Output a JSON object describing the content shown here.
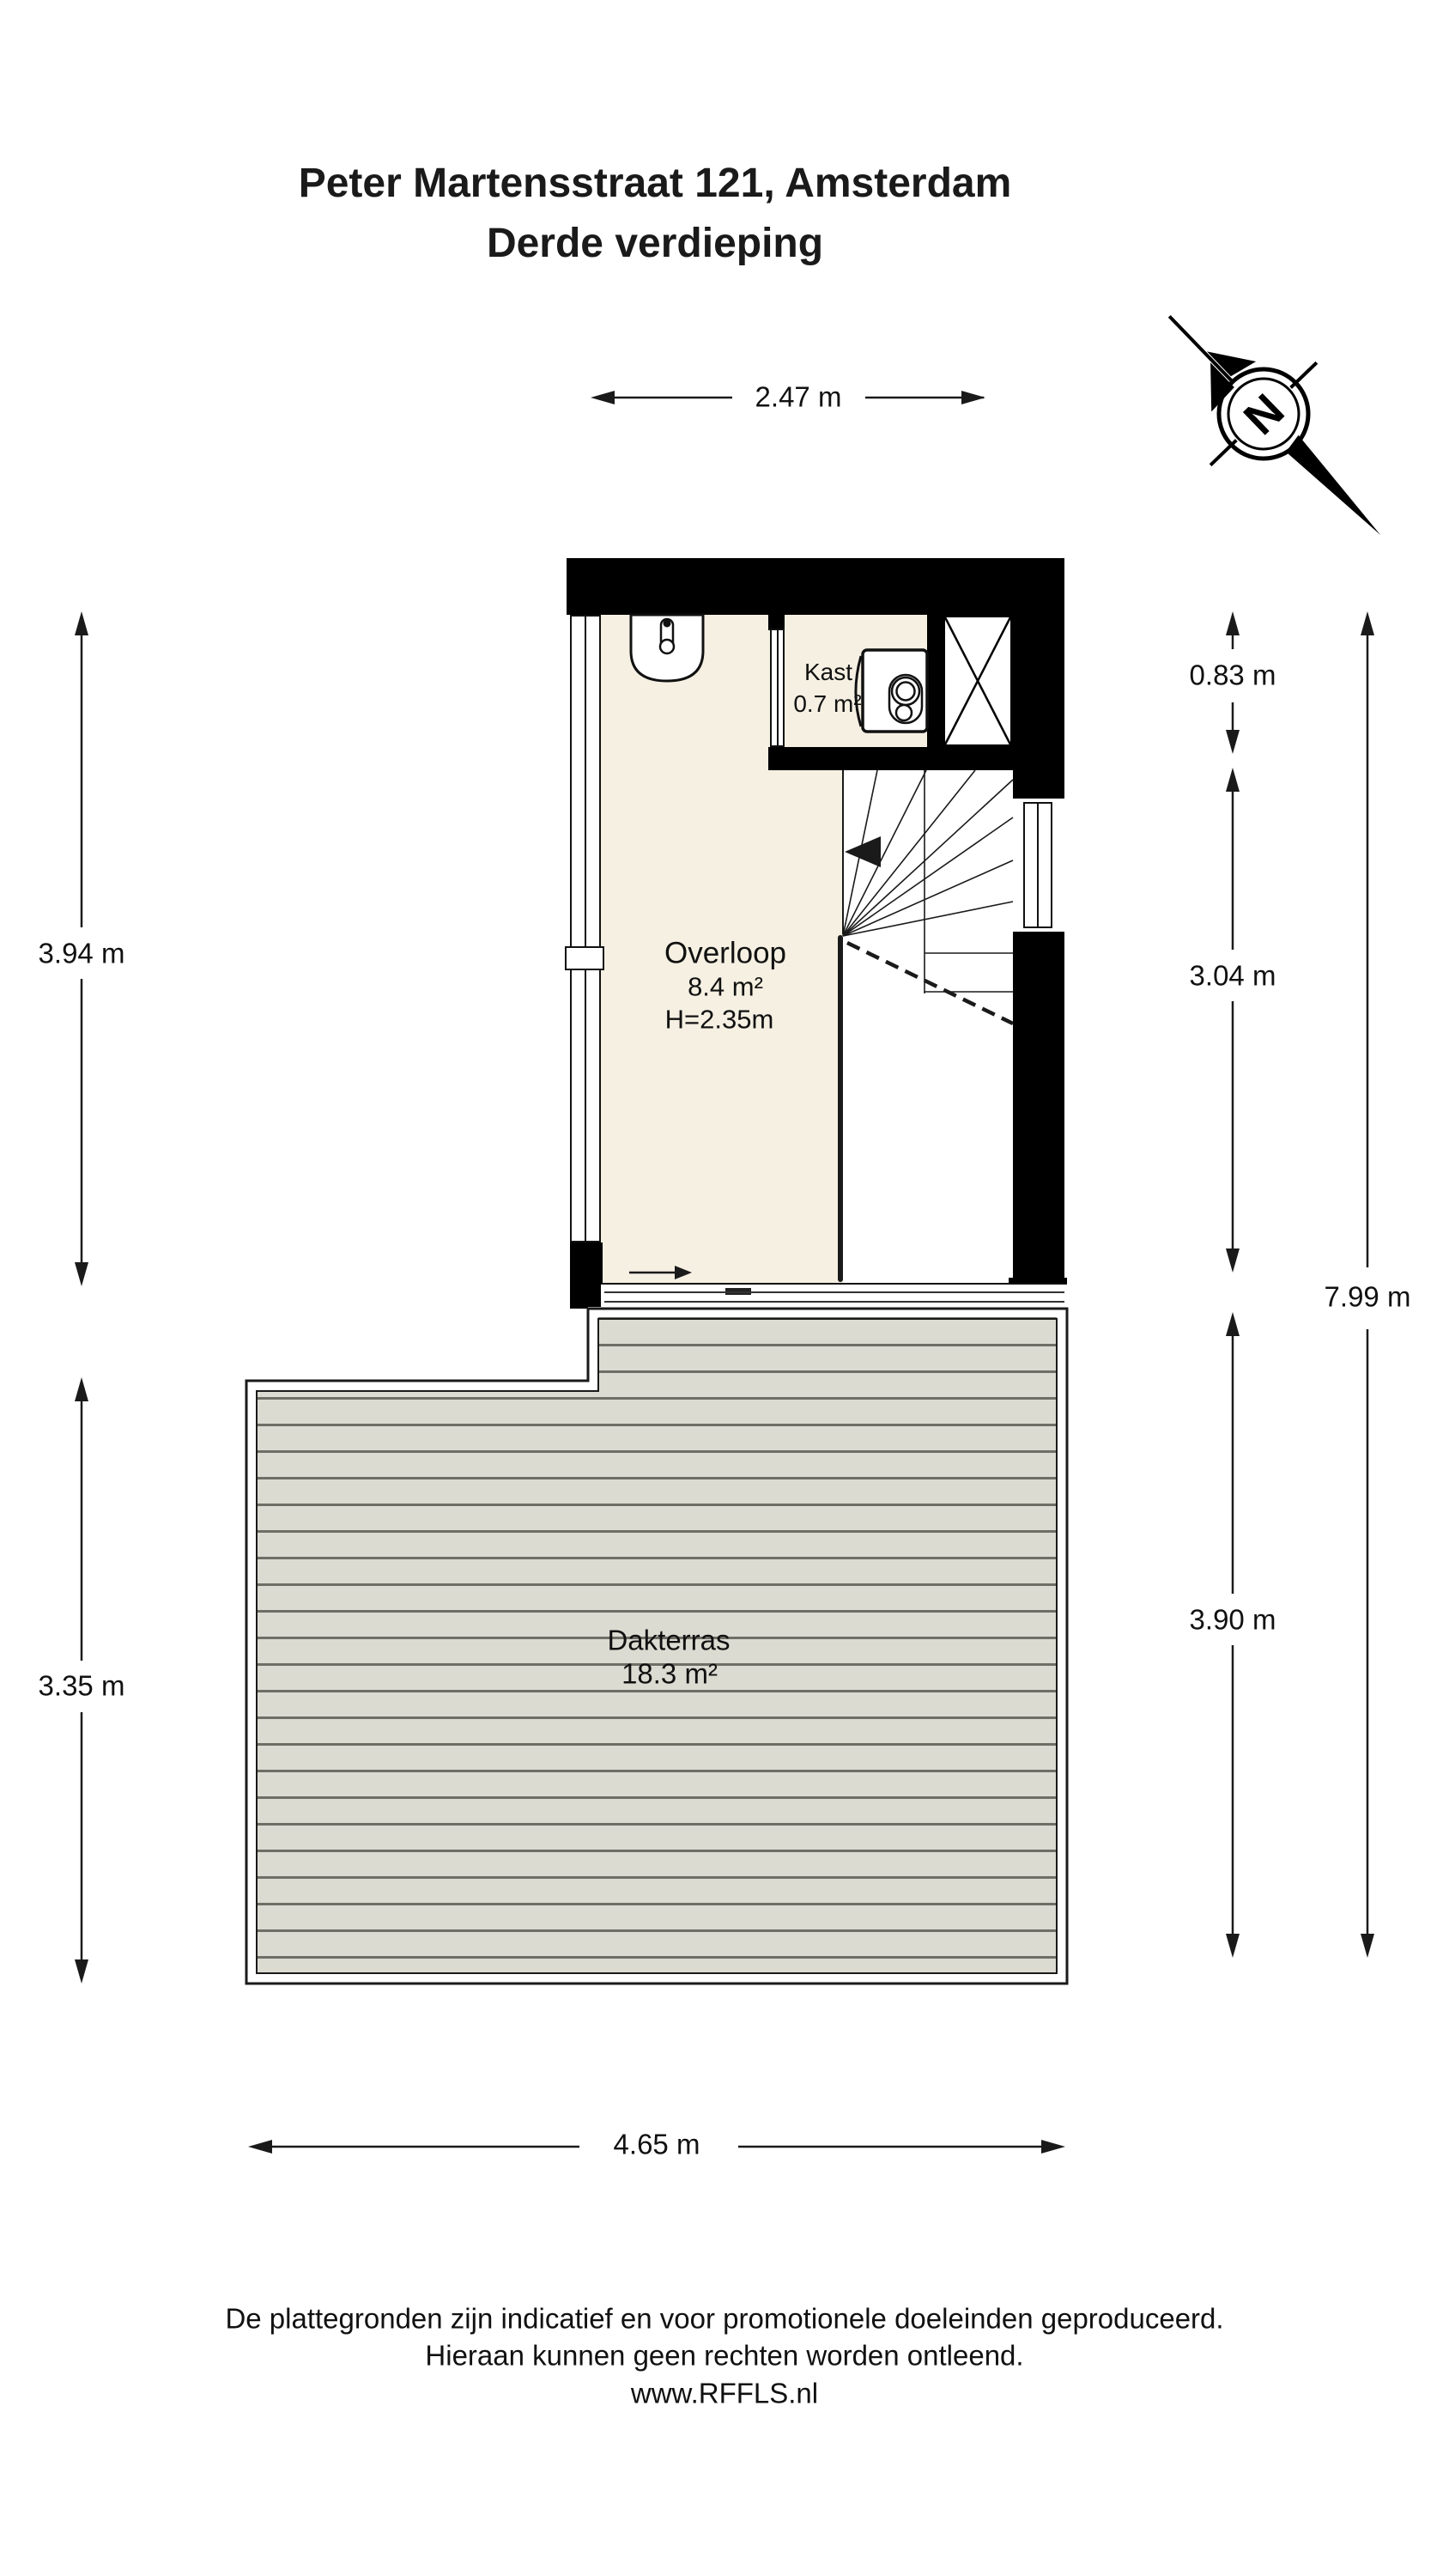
{
  "title": {
    "line1": "Peter Martensstraat 121, Amsterdam",
    "line2": "Derde verdieping"
  },
  "compass": {
    "label": "N"
  },
  "rooms": {
    "overloop": {
      "name": "Overloop",
      "area": "8.4 m²",
      "ceiling_height": "H=2.35m"
    },
    "kast": {
      "name": "Kast",
      "area": "0.7 m²"
    },
    "dakterras": {
      "name": "Dakterras",
      "area": "18.3 m²"
    }
  },
  "dimensions": {
    "top_width": "2.47 m",
    "left_upper": "3.94 m",
    "left_lower": "3.35 m",
    "right_upper": "0.83 m",
    "right_middle": "3.04 m",
    "right_lower": "3.90 m",
    "right_total": "7.99 m",
    "bottom_width": "4.65 m"
  },
  "footer": {
    "line1": "De plattegronden zijn indicatief en voor promotionele doeleinden geproduceerd.",
    "line2": "Hieraan kunnen geen rechten worden ontleend.",
    "line3": "www.RFFLS.nl"
  },
  "colors": {
    "wall": "#000000",
    "floor": "#f5f0e2",
    "terrace_plank": "#dcdbd2",
    "terrace_line": "#6f6e66",
    "line": "#1a1a1a"
  }
}
